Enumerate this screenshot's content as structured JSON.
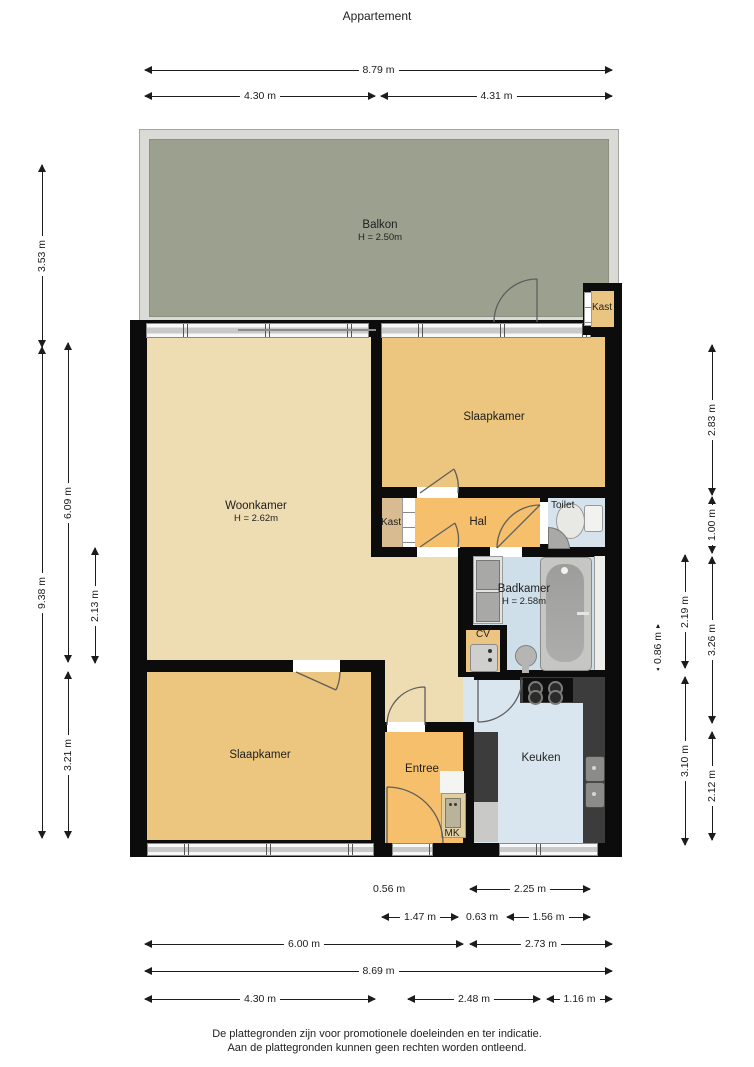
{
  "title": "Appartement",
  "footer": {
    "line1": "De plattegronden zijn voor promotionele doeleinden en ter indicatie.",
    "line2": "Aan de plattegronden kunnen geen rechten worden ontleend."
  },
  "rooms": {
    "balkon": {
      "name": "Balkon",
      "height": "H = 2.50m"
    },
    "kast_balkon": {
      "name": "Kast"
    },
    "slaapkamer_top": {
      "name": "Slaapkamer"
    },
    "woonkamer": {
      "name": "Woonkamer",
      "height": "H = 2.62m"
    },
    "kast_hal": {
      "name": "Kast"
    },
    "hal": {
      "name": "Hal"
    },
    "toilet": {
      "name": "Toilet"
    },
    "badkamer": {
      "name": "Badkamer",
      "height": "H = 2.58m"
    },
    "cv": {
      "name": "CV"
    },
    "slaapkamer_bottom": {
      "name": "Slaapkamer"
    },
    "entree": {
      "name": "Entree"
    },
    "mk": {
      "name": "MK"
    },
    "keuken": {
      "name": "Keuken"
    }
  },
  "dimensions": {
    "top": [
      {
        "label": "8.79 m"
      },
      {
        "label": "4.30 m"
      },
      {
        "label": "4.31 m"
      }
    ],
    "left": [
      {
        "label": "3.53 m"
      },
      {
        "label": "9.38 m"
      },
      {
        "label": "6.09 m"
      },
      {
        "label": "2.13 m"
      },
      {
        "label": "3.21 m"
      }
    ],
    "right": [
      {
        "label": "2.83 m"
      },
      {
        "label": "1.00 m"
      },
      {
        "label": "0.86 m"
      },
      {
        "label": "2.19 m"
      },
      {
        "label": "3.26 m"
      },
      {
        "label": "3.10 m"
      },
      {
        "label": "2.12 m"
      }
    ],
    "bottom": [
      {
        "label": "0.56 m"
      },
      {
        "label": "2.25 m"
      },
      {
        "label": "1.47 m"
      },
      {
        "label": "0.63 m"
      },
      {
        "label": "1.56 m"
      },
      {
        "label": "6.00 m"
      },
      {
        "label": "2.73 m"
      },
      {
        "label": "8.69 m"
      },
      {
        "label": "4.30 m"
      },
      {
        "label": "2.48 m"
      },
      {
        "label": "1.16 m"
      }
    ]
  },
  "colors": {
    "wall": "#0c0c0c",
    "balkon_floor": "#9ba18e",
    "balkon_frame": "#dadad6",
    "woonkamer": "#eedcb3",
    "slaapkamer": "#ecc57e",
    "hal_entree": "#f6bf6b",
    "kast": "#d8bb90",
    "kast_balkon": "#eac581",
    "toilet": "#d6e3ed",
    "badkamer": "#cfdfe9",
    "keuken_floor": "#dae6ef",
    "cv": "#ecc583",
    "counter": "#3c3c3c",
    "stove": "#0f0f0f"
  }
}
